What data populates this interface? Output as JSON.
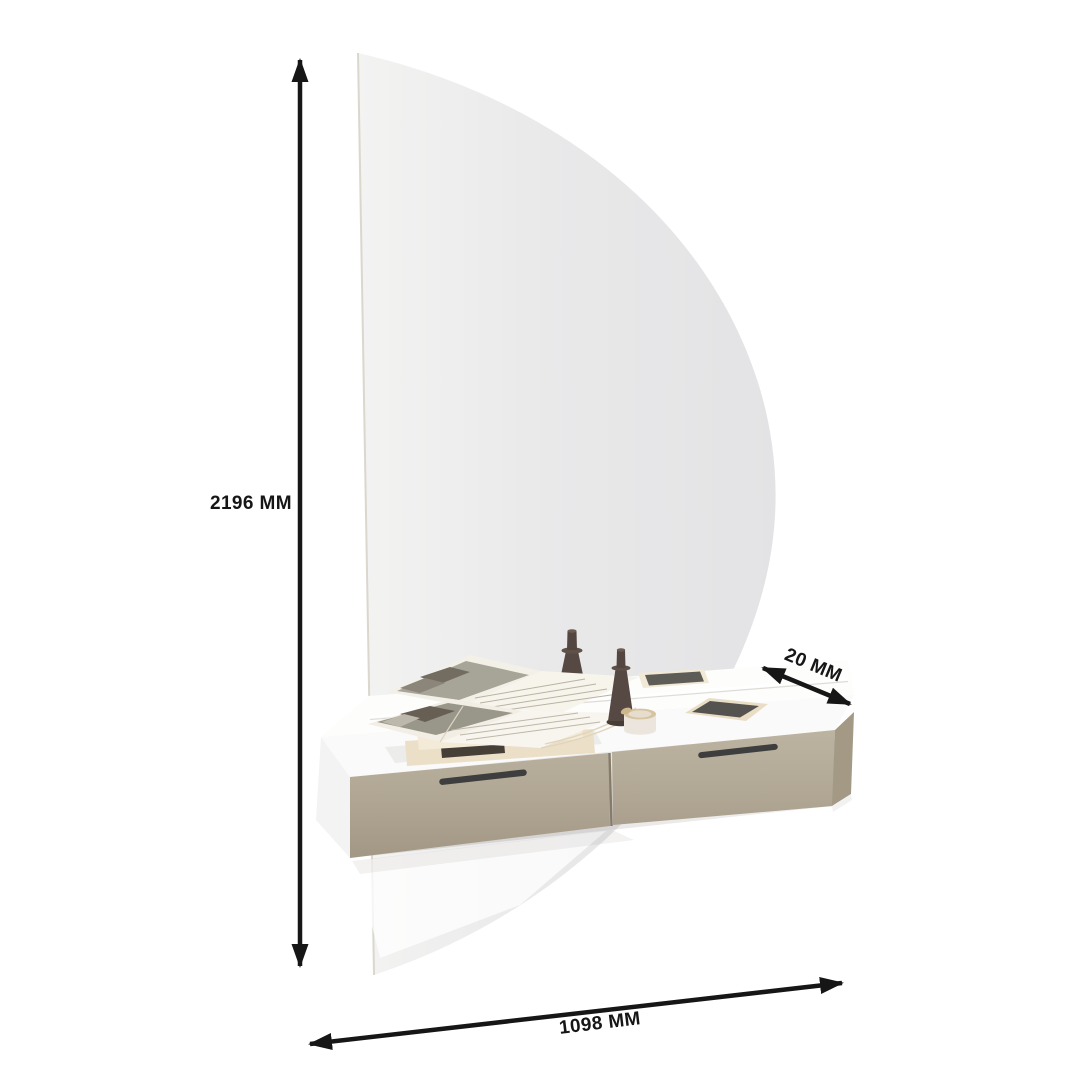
{
  "dimensions": {
    "height": {
      "label": "2196 MM"
    },
    "depth": {
      "label": "20 MM"
    },
    "width": {
      "label": "1098 MM"
    }
  },
  "scene": {
    "items": [
      "half-moon-mirror-panel",
      "wall-console-with-two-drawers",
      "open-magazines-stack",
      "candlestick-back",
      "candlestick-front",
      "cosmetic-jar",
      "tablet",
      "phone-reflection-in-mirror"
    ],
    "colors": {
      "background": "#ffffff",
      "annotation": "#161616",
      "mirror_glass_left": "#f3f3f2",
      "mirror_glass_right": "#e4e4e6",
      "mirror_edge": "#d5d1c6",
      "carcass_white": "#fafafa",
      "drawer_front": "#b3a894",
      "drawer_side": "#a39985",
      "handle": "#3e3e3e",
      "candle": "#564842",
      "book_cover": "#ecdfc8",
      "tablet_frame": "#e9dec5",
      "screen": "#55534f"
    }
  }
}
